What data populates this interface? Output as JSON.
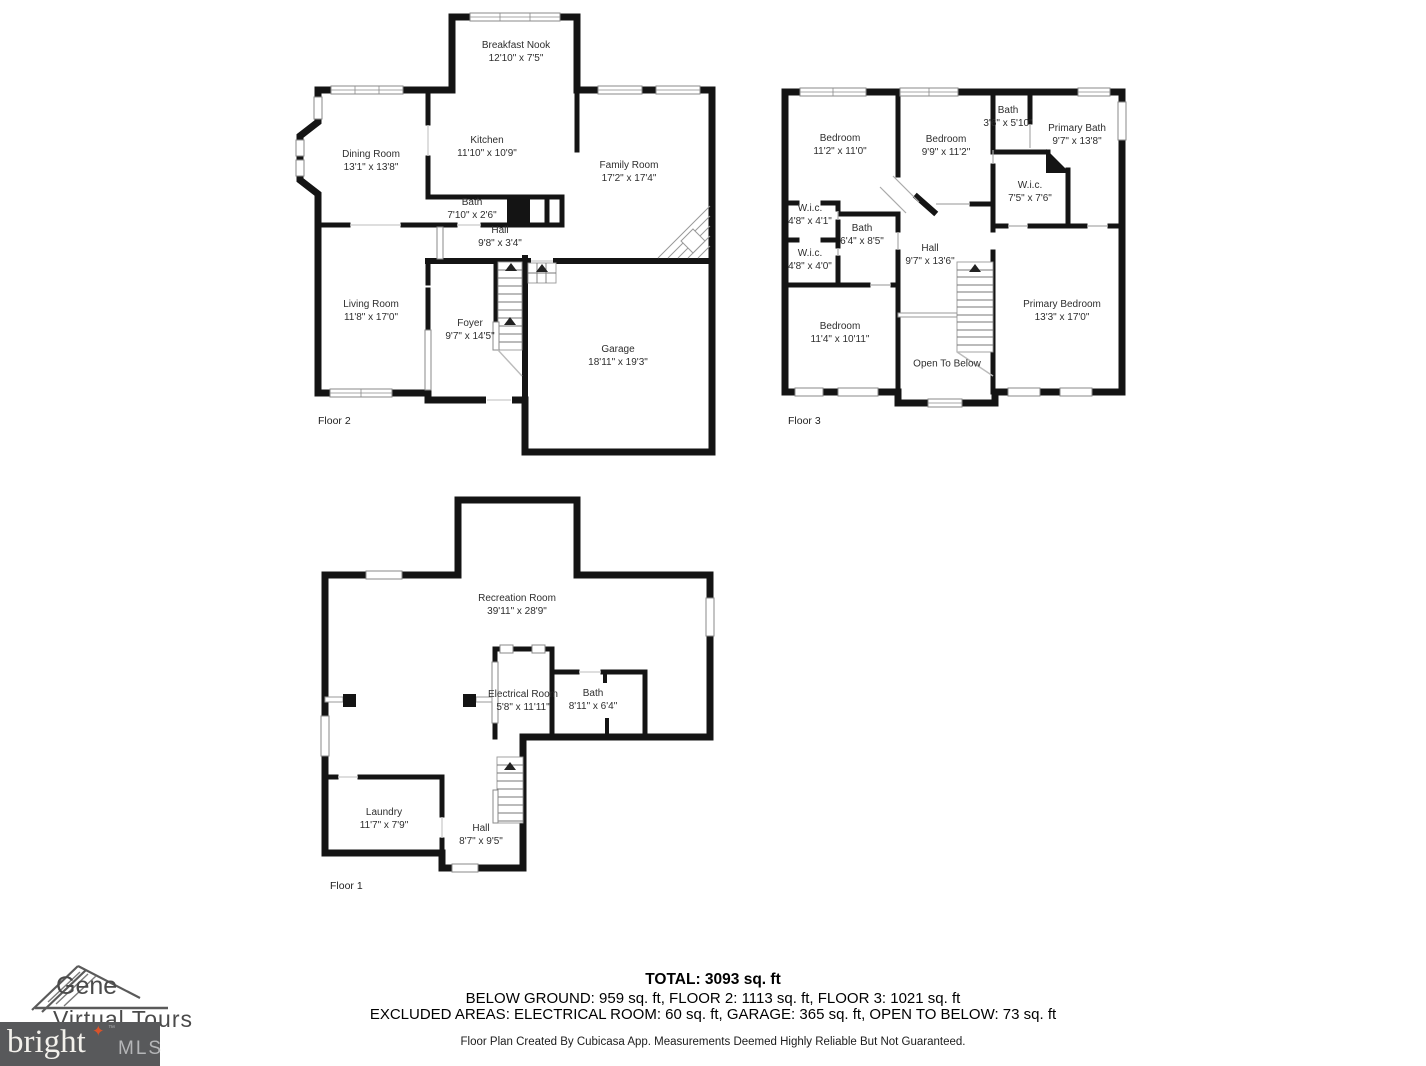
{
  "colors": {
    "wall": "#141414",
    "label_text": "#2e2e2e",
    "footer_text": "#000000",
    "mls_box_background": "#58595b",
    "mls_star": "#d9532b"
  },
  "floor2": {
    "label": "Floor 2",
    "rooms": [
      {
        "name": "Breakfast Nook",
        "dims": "12'10\" x 7'5\""
      },
      {
        "name": "Dining Room",
        "dims": "13'1\" x 13'8\""
      },
      {
        "name": "Kitchen",
        "dims": "11'10\" x 10'9\""
      },
      {
        "name": "Family Room",
        "dims": "17'2\" x 17'4\""
      },
      {
        "name": "Bath",
        "dims": "7'10\" x 2'6\""
      },
      {
        "name": "Hall",
        "dims": "9'8\" x 3'4\""
      },
      {
        "name": "Living Room",
        "dims": "11'8\" x 17'0\""
      },
      {
        "name": "Foyer",
        "dims": "9'7\" x 14'5\""
      },
      {
        "name": "Garage",
        "dims": "18'11\" x 19'3\""
      }
    ]
  },
  "floor3": {
    "label": "Floor 3",
    "rooms": [
      {
        "name": "Bedroom",
        "dims": "11'2\" x 11'0\""
      },
      {
        "name": "Bedroom",
        "dims": "9'9\" x 11'2\""
      },
      {
        "name": "Bath",
        "dims": "3'6\" x 5'10\""
      },
      {
        "name": "Primary Bath",
        "dims": "9'7\" x 13'8\""
      },
      {
        "name": "W.i.c.",
        "dims": "7'5\" x 7'6\""
      },
      {
        "name": "W.i.c.",
        "dims": "4'8\" x 4'1\""
      },
      {
        "name": "Bath",
        "dims": "6'4\" x 8'5\""
      },
      {
        "name": "W.i.c.",
        "dims": "4'8\" x 4'0\""
      },
      {
        "name": "Hall",
        "dims": "9'7\" x 13'6\""
      },
      {
        "name": "Bedroom",
        "dims": "11'4\" x 10'11\""
      },
      {
        "name": "Open To Below",
        "dims": ""
      },
      {
        "name": "Primary Bedroom",
        "dims": "13'3\" x 17'0\""
      }
    ]
  },
  "floor1": {
    "label": "Floor 1",
    "rooms": [
      {
        "name": "Recreation Room",
        "dims": "39'11\" x 28'9\""
      },
      {
        "name": "Electrical Room",
        "dims": "5'8\" x 11'11\""
      },
      {
        "name": "Bath",
        "dims": "8'11\" x 6'4\""
      },
      {
        "name": "Laundry",
        "dims": "11'7\" x 7'9\""
      },
      {
        "name": "Hall",
        "dims": "8'7\" x 9'5\""
      }
    ]
  },
  "footer": {
    "total": "TOTAL: 3093 sq. ft",
    "by_floor": "BELOW GROUND: 959 sq. ft, FLOOR 2: 1113 sq. ft, FLOOR 3: 1021 sq. ft",
    "excluded": "EXCLUDED AREAS: ELECTRICAL ROOM: 60 sq. ft, GARAGE: 365 sq. ft, OPEN TO BELOW: 73 sq. ft",
    "disclaimer": "Floor Plan Created By Cubicasa App. Measurements Deemed Highly Reliable But Not Guaranteed."
  },
  "logo": {
    "brand_line1": "Gene",
    "brand_line2": "Virtual Tours",
    "mls_word": "bright",
    "mls_tm": "™",
    "mls_suffix": "MLS"
  }
}
